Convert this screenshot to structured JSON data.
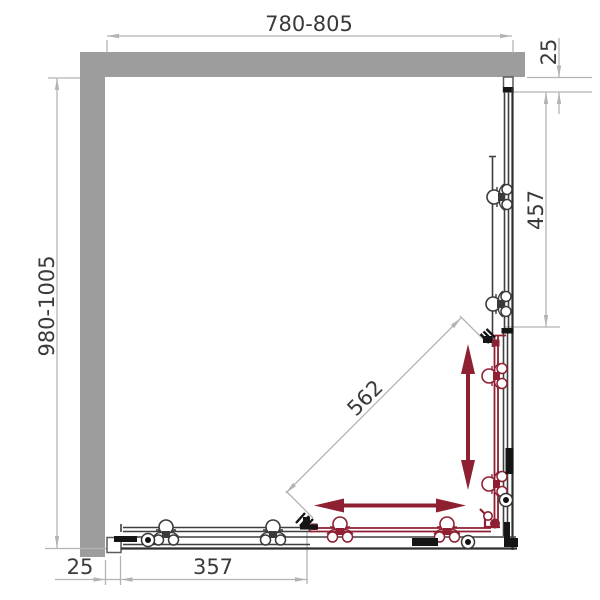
{
  "drawing": {
    "type": "shower-enclosure-plan",
    "dims": {
      "top_width": "780-805",
      "left_depth": "980-1005",
      "top_wall_profile": "25",
      "right_fixed_panel": "457",
      "diagonal_entry": "562",
      "bottom_wall_profile": "25",
      "bottom_fixed_panel": "357"
    },
    "colors": {
      "wall": "#9d9d9d",
      "dimension": "#b3b3b3",
      "frame": "#3f3f3f",
      "accent_red": "#8e2032",
      "background": "#ffffff"
    }
  }
}
